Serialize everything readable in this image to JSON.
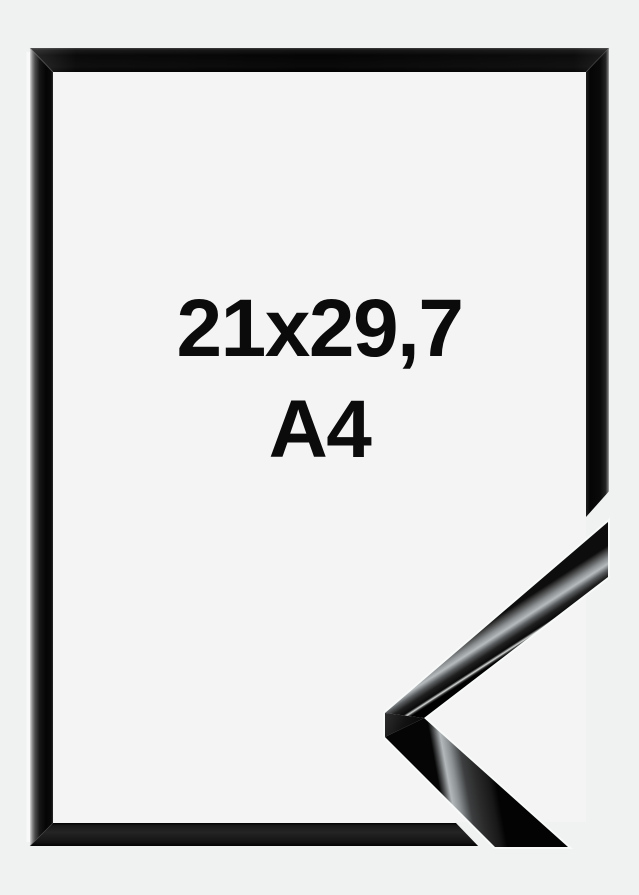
{
  "photo": {
    "size_label": {
      "dimensions": "21x29,7",
      "format": "A4"
    },
    "colors": {
      "background": "#f0f1f1",
      "frame_opening": "#f4f4f5",
      "frame_gloss_black": "#0a0a0a",
      "metal_highlight": "#b6bbbd",
      "label_text": "#0b0b0b"
    }
  }
}
